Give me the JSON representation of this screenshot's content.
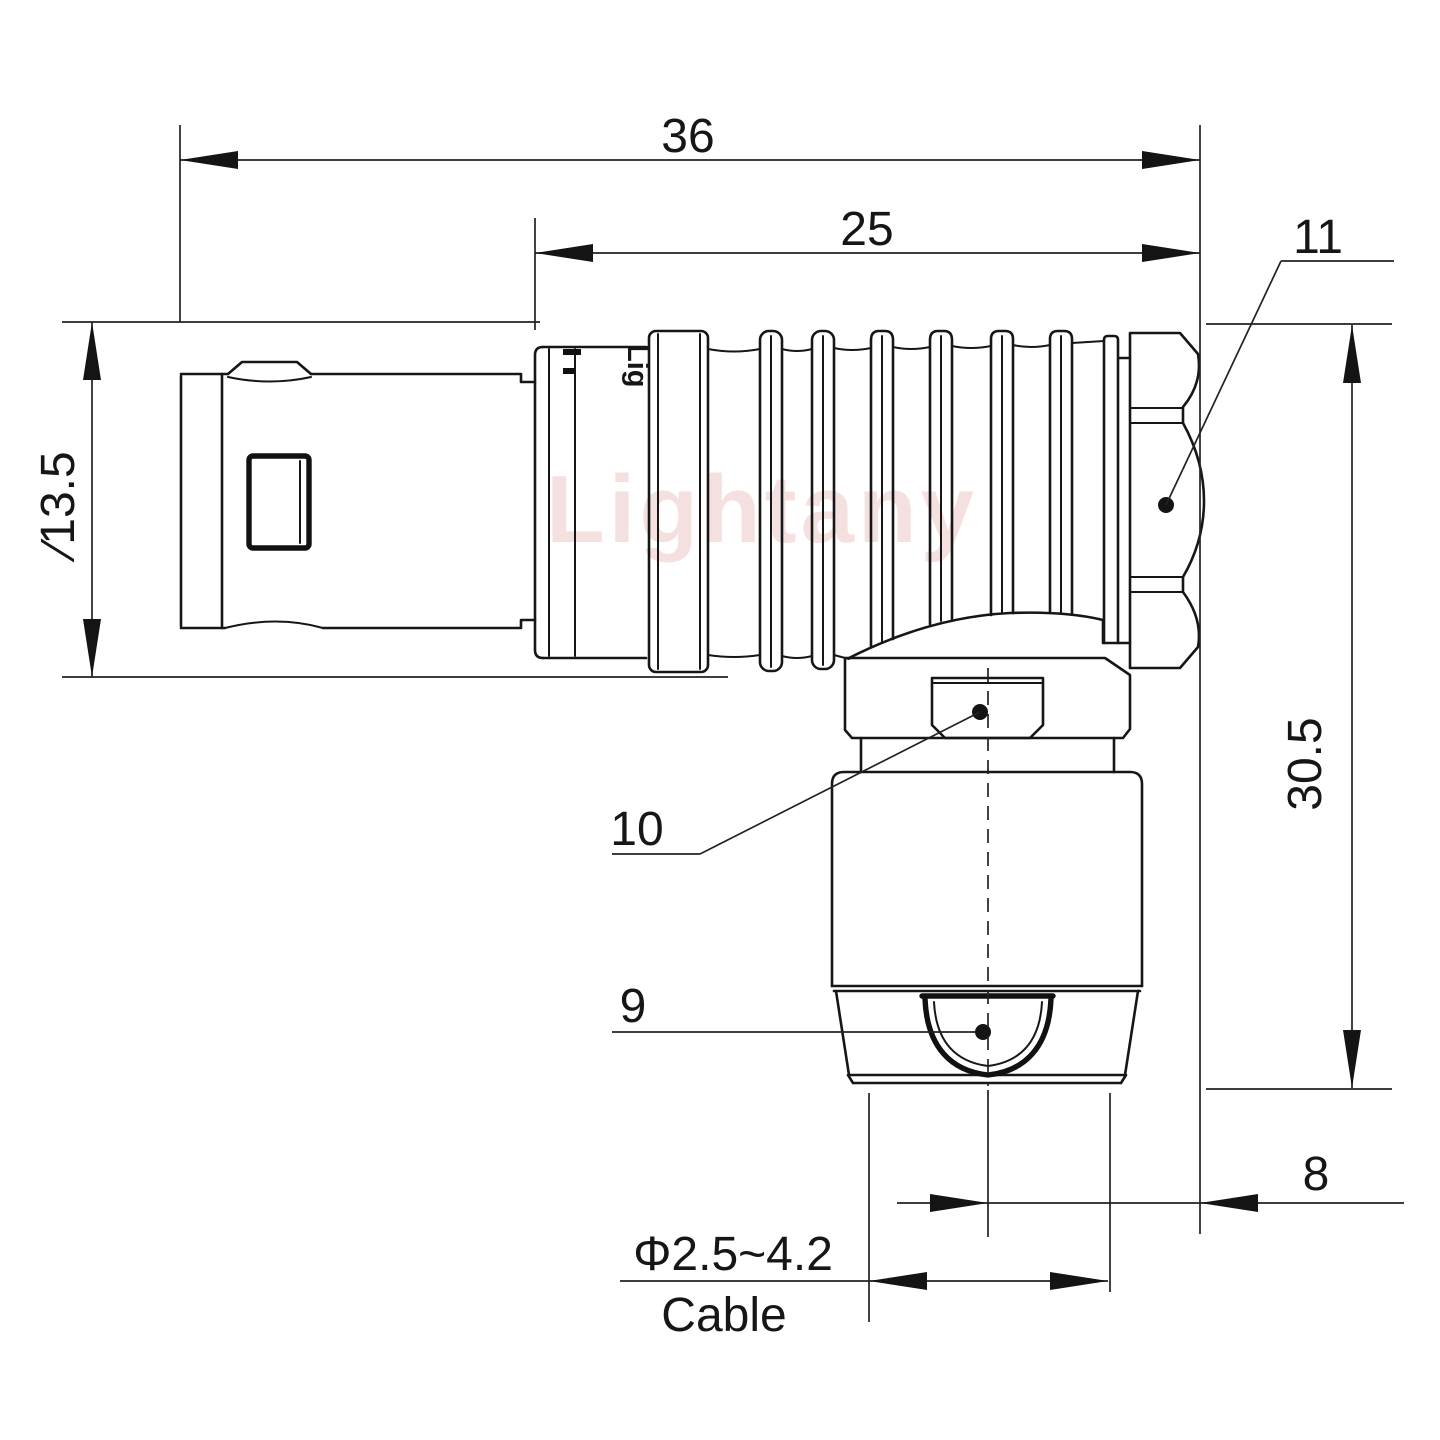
{
  "drawing": {
    "watermark": "Lightany",
    "sleeve_marking": "Lig",
    "dimensions": {
      "overall_length": "36",
      "body_length": "25",
      "front_diameter": "∕13.5",
      "height": "30.5",
      "cable_exit_offset": "8",
      "cable_range": "Φ2.5~4.2",
      "cable_label": "Cable"
    },
    "callouts": {
      "coupling_nut": "11",
      "gland_nut": "10",
      "strain_relief": "9"
    },
    "colors": {
      "line": "#161616",
      "watermark_pink": "#e9b6b6",
      "background": "#ffffff"
    }
  }
}
